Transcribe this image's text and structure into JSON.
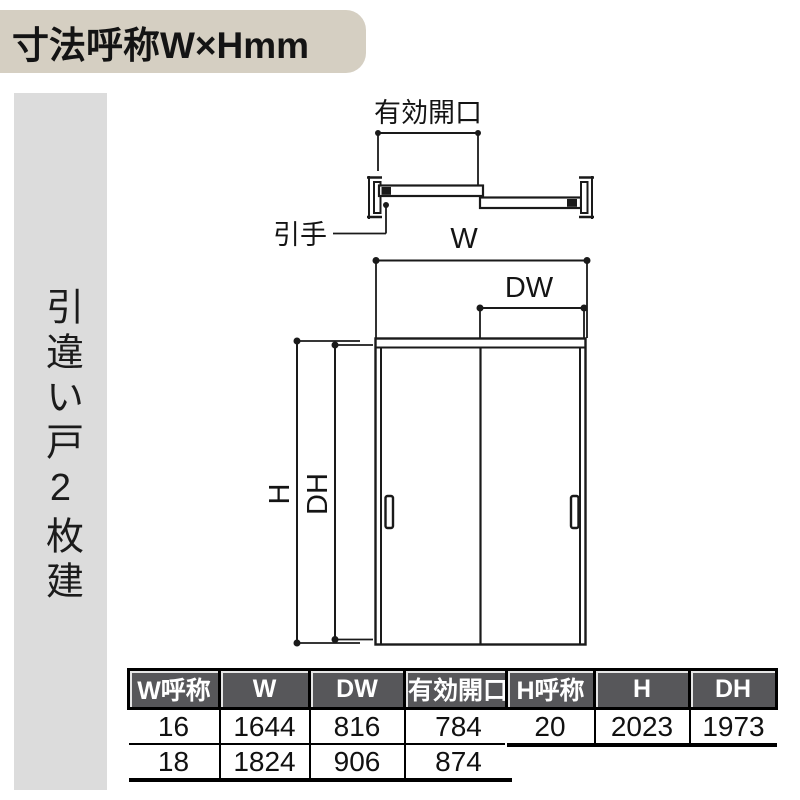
{
  "title": {
    "label": "寸法呼称W×Hmm"
  },
  "sidebar": {
    "label": "引違い戸2枚建"
  },
  "diagram": {
    "plan": {
      "opening_label": "有効開口",
      "handle_label": "引手"
    },
    "elevation": {
      "w_label": "W",
      "dw_label": "DW",
      "h_label": "H",
      "dh_label": "DH"
    }
  },
  "tables": {
    "width": {
      "headers": [
        "W呼称",
        "W",
        "DW",
        "有効開口"
      ],
      "rows": [
        [
          "16",
          "1644",
          "816",
          "784"
        ],
        [
          "18",
          "1824",
          "906",
          "874"
        ]
      ]
    },
    "height": {
      "headers": [
        "H呼称",
        "H",
        "DH"
      ],
      "rows": [
        [
          "20",
          "2023",
          "1973"
        ]
      ]
    }
  },
  "colors": {
    "banner_bg": "#d5cfc2",
    "sidebar_bg": "#dcdcdc",
    "table_header_bg": "#57575a",
    "table_header_text": "#ffffff",
    "line": "#1a1a1a"
  }
}
